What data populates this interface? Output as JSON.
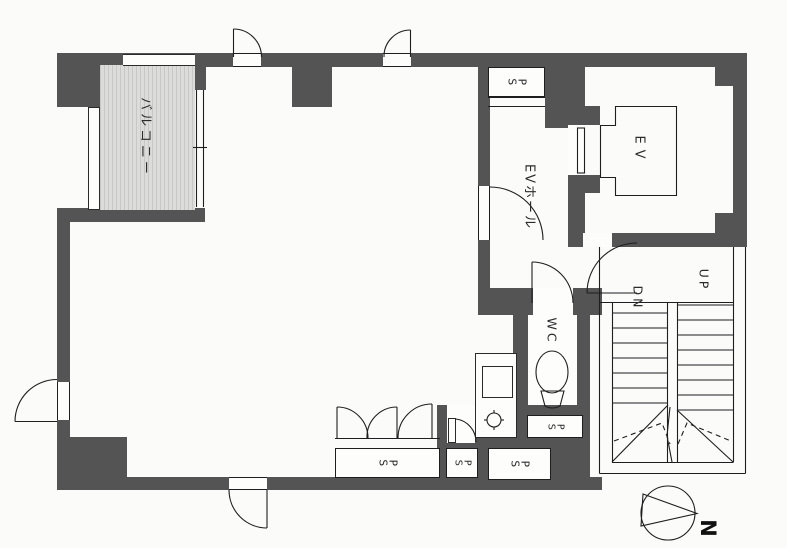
{
  "title": "floor-plan",
  "colors": {
    "wall": "#545454",
    "line": "#1e1e1e",
    "balcony_fill": "#dcdcda",
    "paper": "#fbfbf9"
  },
  "labels": {
    "balcony": "バルコニー",
    "ev_hall": "EVホール",
    "elevator": "EV",
    "wc": "WC",
    "up": "UP",
    "down": "DN",
    "pipe_space": "P\nS",
    "north": "N"
  }
}
